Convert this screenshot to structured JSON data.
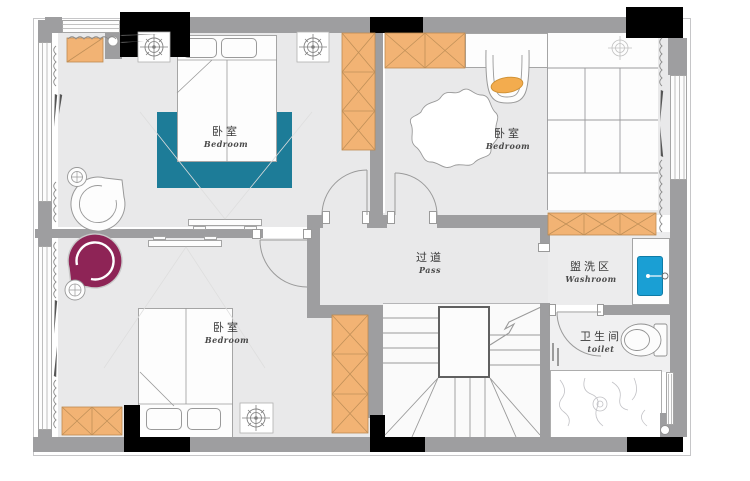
{
  "plan_title": "二层平面布置图",
  "rooms": {
    "bedroom1": {
      "zh": "卧室",
      "en": "Bedroom"
    },
    "bedroom2": {
      "zh": "卧室",
      "en": "Bedroom"
    },
    "bedroom3": {
      "zh": "卧室",
      "en": "Bedroom"
    },
    "corridor": {
      "zh": "过道",
      "en": "Pass"
    },
    "washroom": {
      "zh": "盥洗区",
      "en": "Washroom"
    },
    "toilet": {
      "zh": "卫生间",
      "en": "toilet"
    }
  },
  "colors": {
    "wall_gray": "#9e9ea0",
    "wall_black": "#000000",
    "floor": "#e9e9ea",
    "cabinet_orange": "#f2b374",
    "rug_teal": "#1d7c98",
    "armchair_purple": "#8e2456",
    "sink_blue": "#1a9fd4",
    "cushion_orange": "#f3ac4e"
  }
}
